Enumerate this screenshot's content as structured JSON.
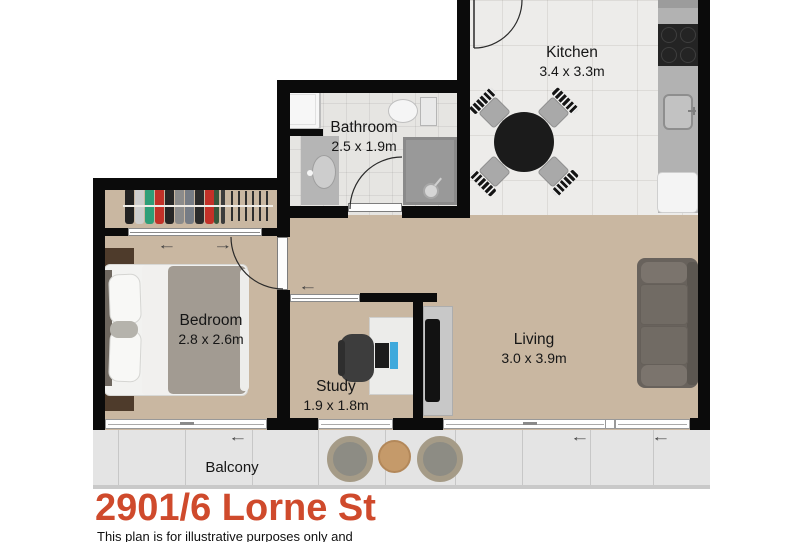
{
  "title": "2901/6 Lorne St",
  "disclaimer": "This plan is for illustrative purposes only and",
  "rooms": {
    "kitchen": {
      "name": "Kitchen",
      "dims": "3.4 x 3.3m"
    },
    "bathroom": {
      "name": "Bathroom",
      "dims": "2.5 x 1.9m"
    },
    "bedroom": {
      "name": "Bedroom",
      "dims": "2.8 x 2.6m"
    },
    "study": {
      "name": "Study",
      "dims": "1.9 x 1.8m"
    },
    "living": {
      "name": "Living",
      "dims": "3.0 x 3.9m"
    },
    "balcony": {
      "name": "Balcony"
    }
  },
  "glyphs": {
    "arrow_left": "←",
    "arrow_right": "→"
  },
  "colors": {
    "title_accent": "#cf4a2c",
    "wall": "#0b0b0b",
    "carpet": "#c9b7a1",
    "kitchen_tile": "#edecea",
    "bathroom_tile": "#e6e5e2",
    "balcony_floor": "#e4e4e4",
    "sofa": "#6b6560",
    "duvet": "#a29b92",
    "counter": "#b2b2b2",
    "pc_accent": "#3fa9dc",
    "clothes_red": "#c23128",
    "clothes_green": "#2e9e78"
  }
}
